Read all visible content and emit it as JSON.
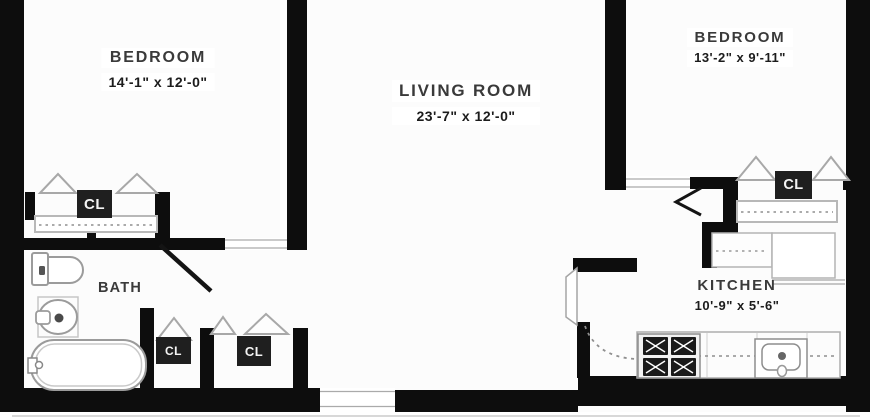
{
  "colors": {
    "wall": "#0d0d0d",
    "fixture": "#9b9b9b",
    "lightline": "#c6c6c6",
    "dash": "#8f8f8f",
    "labeltext": "#3a3a3a",
    "dimstext": "#1c1c1c",
    "clbg": "#1f1f1f",
    "cltext": "#f4f4f4",
    "floor": "#fcfcfc"
  },
  "rooms": {
    "bedroom_left": {
      "name": "BEDROOM",
      "dims": "14'-1\" x 12'-0\""
    },
    "living_room": {
      "name": "LIVING ROOM",
      "dims": "23'-7\" x 12'-0\""
    },
    "bedroom_right": {
      "name": "BEDROOM",
      "dims": "13'-2\" x 9'-11\""
    },
    "bath": {
      "name": "BATH"
    },
    "kitchen": {
      "name": "KITCHEN",
      "dims": "10'-9\" x 5'-6\""
    }
  },
  "closets": [
    {
      "label": "CL"
    },
    {
      "label": "CL"
    },
    {
      "label": "CL"
    },
    {
      "label": "CL"
    }
  ],
  "icons": [
    "toilet-icon",
    "pedestal-sink-icon",
    "bathtub-icon",
    "bifold-closet-door-icon",
    "closet-rod-dashed-icon",
    "door-leaf-icon",
    "door-swing-dashed-icon",
    "stove-icon",
    "kitchen-sink-icon",
    "refrigerator-icon",
    "upper-cabinet-icon"
  ]
}
